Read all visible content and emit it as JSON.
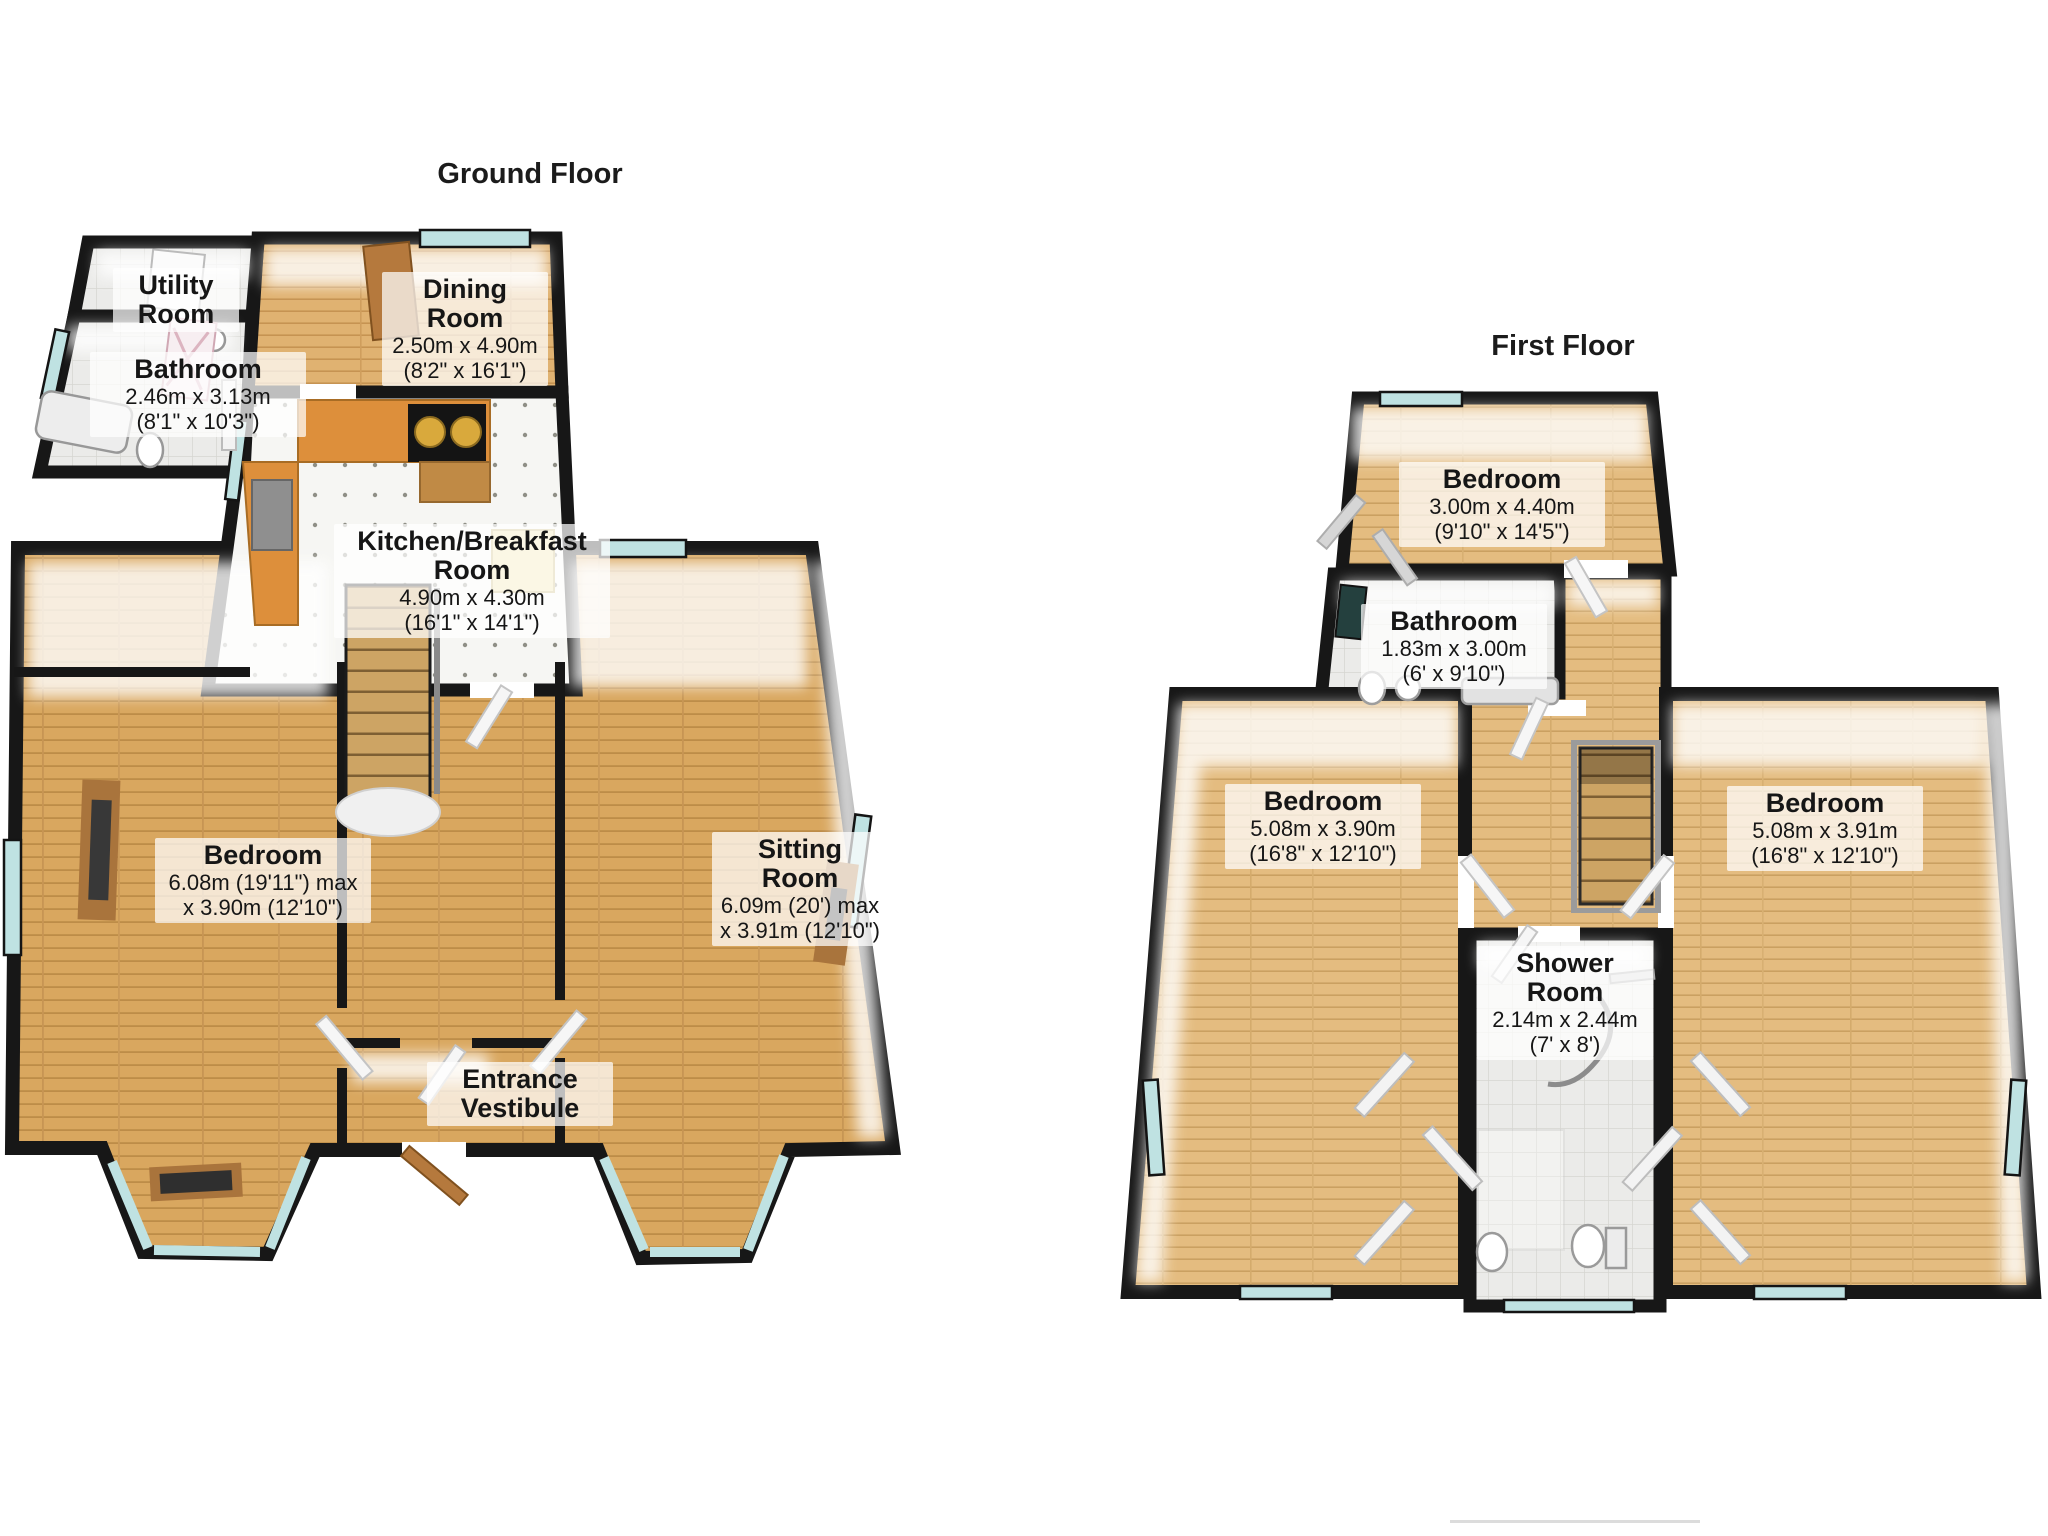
{
  "ground_floor": {
    "title": "Ground Floor",
    "rooms": {
      "utility": {
        "name": "Utility Room",
        "dim1": "",
        "dim2": ""
      },
      "bathroom": {
        "name": "Bathroom",
        "dim1": "2.46m x 3.13m",
        "dim2": "(8'1\" x 10'3\")"
      },
      "dining": {
        "name": "Dining Room",
        "dim1": "2.50m x 4.90m",
        "dim2": "(8'2\" x 16'1\")"
      },
      "kitchen": {
        "name": "Kitchen/Breakfast Room",
        "dim1": "4.90m x 4.30m",
        "dim2": "(16'1\" x 14'1\")"
      },
      "bedroom": {
        "name": "Bedroom",
        "dim1": "6.08m (19'11\") max",
        "dim2": "x 3.90m (12'10\")"
      },
      "sitting": {
        "name": "Sitting Room",
        "dim1": "6.09m (20') max",
        "dim2": "x 3.91m (12'10\")"
      },
      "vestibule": {
        "name": "Entrance Vestibule",
        "dim1": "",
        "dim2": ""
      }
    }
  },
  "first_floor": {
    "title": "First Floor",
    "rooms": {
      "bedroom_top": {
        "name": "Bedroom",
        "dim1": "3.00m x 4.40m",
        "dim2": "(9'10\" x 14'5\")"
      },
      "bathroom": {
        "name": "Bathroom",
        "dim1": "1.83m x 3.00m",
        "dim2": "(6' x 9'10\")"
      },
      "bedroom_left": {
        "name": "Bedroom",
        "dim1": "5.08m x 3.90m",
        "dim2": "(16'8\" x 12'10\")"
      },
      "bedroom_right": {
        "name": "Bedroom",
        "dim1": "5.08m x 3.91m",
        "dim2": "(16'8\" x 12'10\")"
      },
      "shower": {
        "name": "Shower Room",
        "dim1": "2.14m x 2.44m",
        "dim2": "(7' x 8')"
      }
    }
  },
  "palette": {
    "wall": "#171717",
    "wood_ground": "#d9a75f",
    "wood_first": "#e4bc80",
    "tile": "#ebebe9",
    "window_glass": "#bfe2e2",
    "counter_orange": "#dd8f3b",
    "label_background": "rgba(255,255,255,0.72)"
  }
}
